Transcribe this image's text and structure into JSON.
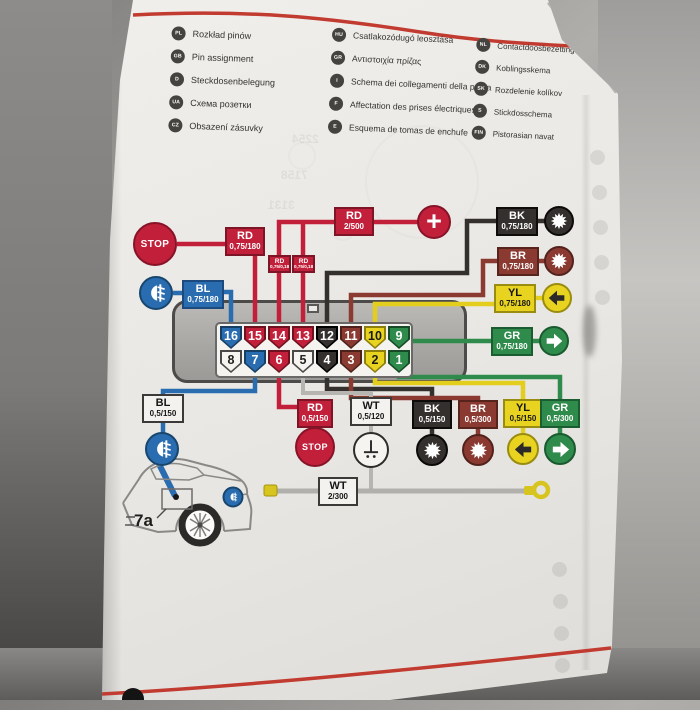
{
  "languages": [
    {
      "code": "PL",
      "label": "Rozkład pinów"
    },
    {
      "code": "GB",
      "label": "Pin assignment"
    },
    {
      "code": "D",
      "label": "Steckdosenbelegung"
    },
    {
      "code": "UA",
      "label": "Схема розетки"
    },
    {
      "code": "CZ",
      "label": "Obsazení zásuvky"
    },
    {
      "code": "HU",
      "label": "Csatlakozódugó leosztása"
    },
    {
      "code": "GR",
      "label": "Αντιστοιχία πρίζας"
    },
    {
      "code": "I",
      "label": "Schema dei collegamenti della presa"
    },
    {
      "code": "F",
      "label": "Affectation des prises électriques"
    },
    {
      "code": "E",
      "label": "Esquema de tomas de enchufe"
    },
    {
      "code": "NL",
      "label": "Contactdoosbezetting"
    },
    {
      "code": "DK",
      "label": "Koblingsskema"
    },
    {
      "code": "SK",
      "label": "Rozdelenie kolíkov"
    },
    {
      "code": "S",
      "label": "Stickdosschema"
    },
    {
      "code": "FIN",
      "label": "Pistorasian navat"
    }
  ],
  "diagram": {
    "pins_top": [
      {
        "num": "16",
        "color": "blue"
      },
      {
        "num": "15",
        "color": "red"
      },
      {
        "num": "14",
        "color": "red"
      },
      {
        "num": "13",
        "color": "red"
      },
      {
        "num": "12",
        "color": "black"
      },
      {
        "num": "11",
        "color": "brown"
      },
      {
        "num": "10",
        "color": "yellow"
      },
      {
        "num": "9",
        "color": "green"
      }
    ],
    "pins_bottom": [
      {
        "num": "8",
        "color": "white"
      },
      {
        "num": "7",
        "color": "blue"
      },
      {
        "num": "6",
        "color": "red"
      },
      {
        "num": "5",
        "color": "white"
      },
      {
        "num": "4",
        "color": "black"
      },
      {
        "num": "3",
        "color": "brown"
      },
      {
        "num": "2",
        "color": "yellow"
      },
      {
        "num": "1",
        "color": "green"
      }
    ],
    "wire_labels": {
      "bl_top": {
        "color": "BL",
        "spec": "0,75/180"
      },
      "rd_top": {
        "color": "RD",
        "spec": "0,75/180"
      },
      "rd_mini1": {
        "color": "RD",
        "spec": "0,75/0,18"
      },
      "rd_mini2": {
        "color": "RD",
        "spec": "0,75/0,18"
      },
      "rd_supply": {
        "color": "RD",
        "spec": "2/500"
      },
      "bk_top": {
        "color": "BK",
        "spec": "0,75/180"
      },
      "br_top": {
        "color": "BR",
        "spec": "0,75/180"
      },
      "yl_top": {
        "color": "YL",
        "spec": "0,75/180"
      },
      "gr_top": {
        "color": "GR",
        "spec": "0,75/180"
      },
      "bl_bottom": {
        "color": "BL",
        "spec": "0,5/150"
      },
      "rd_bottom": {
        "color": "RD",
        "spec": "0,5/150"
      },
      "wt_bottom": {
        "color": "WT",
        "spec": "0,5/120"
      },
      "bk_bottom": {
        "color": "BK",
        "spec": "0,5/150"
      },
      "br_bottom": {
        "color": "BR",
        "spec": "0,5/300"
      },
      "yl_bottom": {
        "color": "YL",
        "spec": "0,5/150"
      },
      "gr_bottom": {
        "color": "GR",
        "spec": "0,5/300"
      },
      "wt_ground": {
        "color": "WT",
        "spec": "2/300"
      }
    },
    "stop_label": "STOP",
    "plus_label": "+",
    "car_ref": "7a",
    "watermarks": [
      "2254",
      "7158",
      "3131"
    ],
    "palette": {
      "red": "#c2203a",
      "blue": "#2a6cb0",
      "black": "#33302d",
      "brown": "#8a3a30",
      "yellow": "#e8d320",
      "green": "#2f8b4b",
      "white_wire": "#b7b5b1",
      "page": "#edebe8",
      "rule_red": "#c23b30"
    }
  }
}
